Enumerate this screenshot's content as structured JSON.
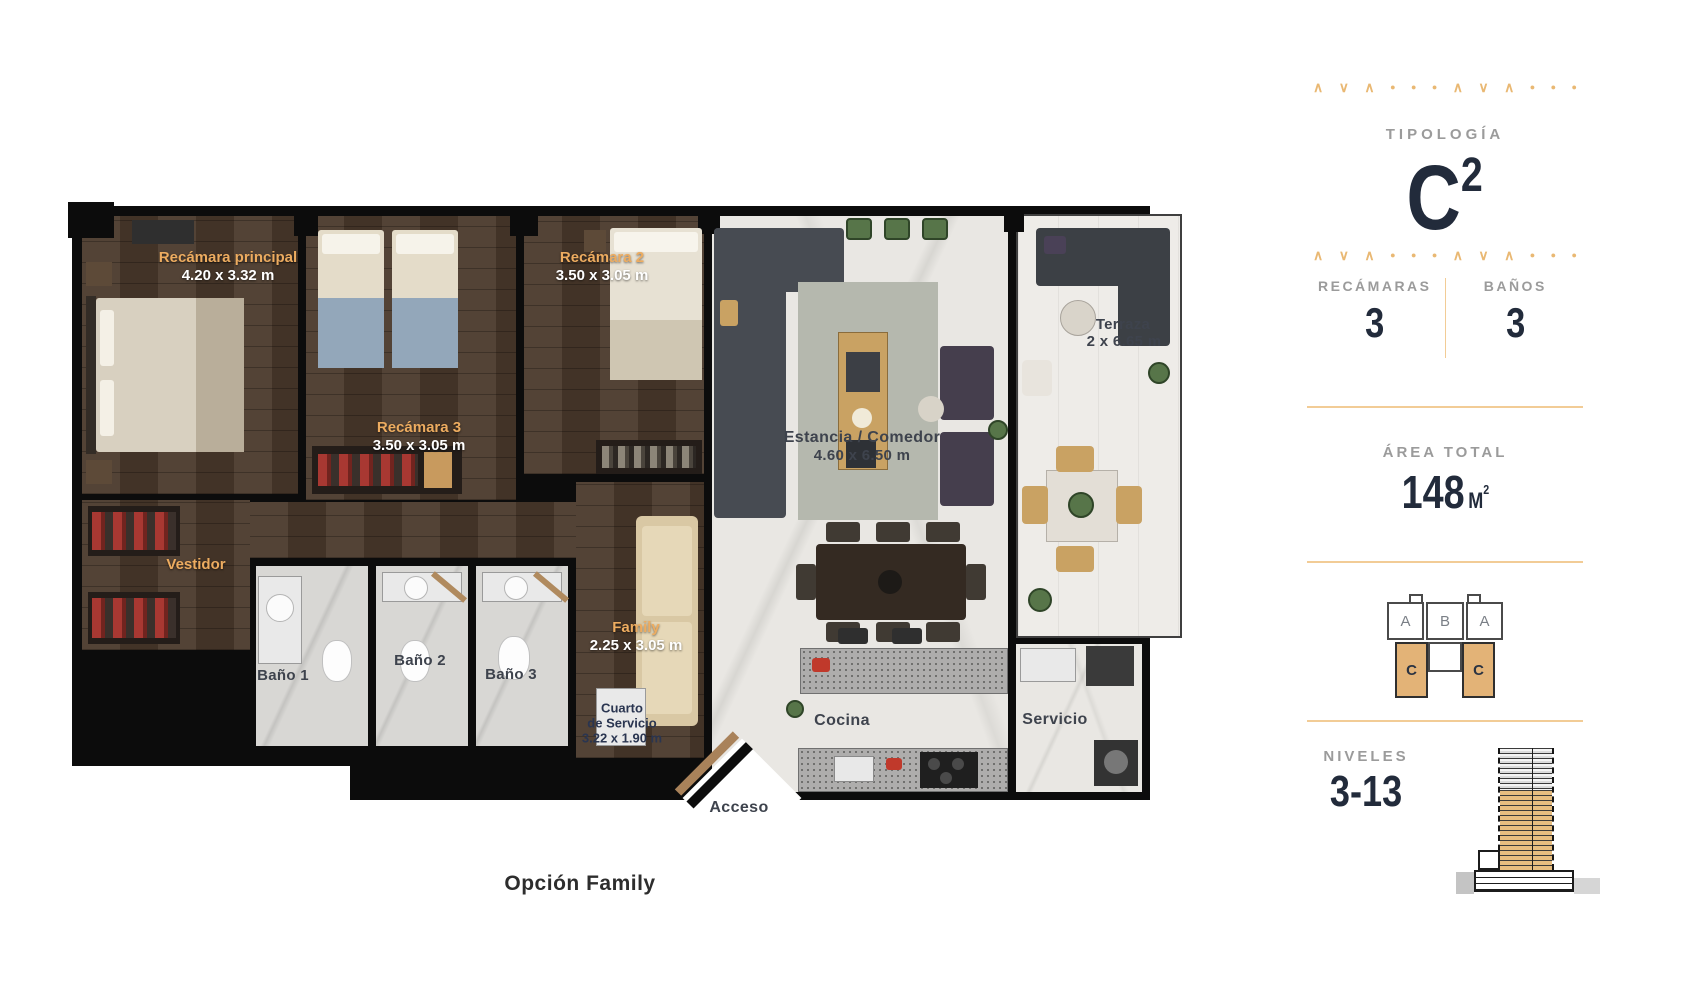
{
  "colors": {
    "accent_gold": "#E9B873",
    "divider_gold": "#F2CC96",
    "navy": "#222B3B",
    "label_gray": "#9B9B9B",
    "highlight_tan": "#E3B377",
    "room_name_gold": "#EDAC60"
  },
  "plan": {
    "caption": "Opción Family",
    "rooms": {
      "master": {
        "name": "Recámara principal",
        "dims": "4.20 x 3.32 m"
      },
      "rec2": {
        "name": "Recámara 2",
        "dims": "3.50 x 3.05 m"
      },
      "rec3": {
        "name": "Recámara 3",
        "dims": "3.50 x 3.05 m"
      },
      "vestidor": {
        "name": "Vestidor"
      },
      "bano1": {
        "name": "Baño 1"
      },
      "bano2": {
        "name": "Baño 2"
      },
      "bano3": {
        "name": "Baño 3"
      },
      "family": {
        "name": "Family",
        "dims": "2.25 x 3.05 m"
      },
      "cuarto_servicio": {
        "line1": "Cuarto",
        "line2": "de Servicio",
        "dims": "3.22 x 1.90 m"
      },
      "estancia": {
        "name": "Estancia / Comedor",
        "dims": "4.60 x 6.50 m"
      },
      "terraza": {
        "name": "Terraza",
        "dims": "2 x 6.65 m"
      },
      "cocina": {
        "name": "Cocina"
      },
      "servicio": {
        "name": "Servicio"
      },
      "acceso": {
        "name": "Acceso"
      }
    }
  },
  "panel": {
    "ornament": [
      "cu",
      "cd",
      "cu",
      "dot",
      "dot",
      "dot",
      "cu",
      "cd",
      "cu",
      "dot",
      "dot",
      "dot"
    ],
    "tipologia": {
      "label": "TIPOLOGÍA",
      "value": "C",
      "sup": "2"
    },
    "stats": [
      {
        "label": "RECÁMARAS",
        "value": "3"
      },
      {
        "label": "BAÑOS",
        "value": "3"
      }
    ],
    "area": {
      "label": "ÁREA TOTAL",
      "value": "148",
      "unit": "M",
      "unit_sup": "2"
    },
    "keyplan": {
      "units_top": [
        "A",
        "B",
        "A"
      ],
      "units_bottom": [
        "C",
        "C"
      ]
    },
    "niveles": {
      "label": "NIVELES",
      "value": "3-13"
    }
  }
}
